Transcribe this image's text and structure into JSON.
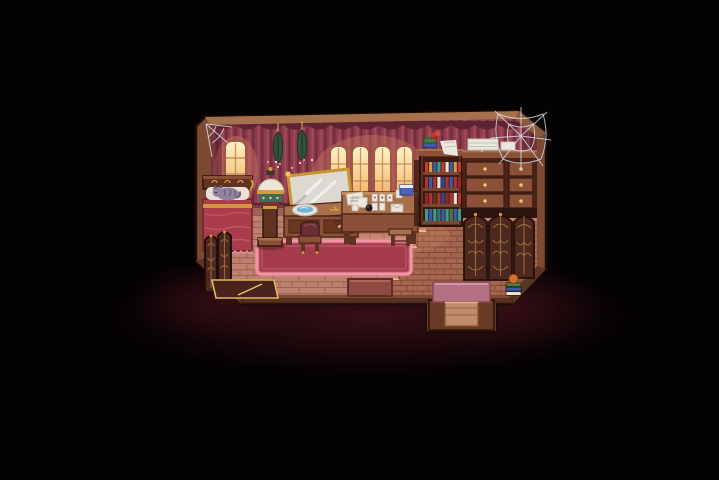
{
  "meta": {
    "scene": "Pixel-art cottage bedroom and study at night, warm candlelit windows, dark vignette surround",
    "view": "top-down RPG room interior",
    "canvas": {
      "width": 719,
      "height": 480
    }
  },
  "palette": {
    "background": "#050203",
    "outerGlow": "#2d0a0e",
    "trim": "#7c4a33",
    "trimLight": "#a5714c",
    "trimDark": "#3a1c11",
    "wall": "#733040",
    "wallBase": "#7e3a44",
    "curtain": "#8e3c4c",
    "curtainDark": "#722e3e",
    "curtainLight": "#a34e5e",
    "valance": "#5d2331",
    "windowFrame": "#9c5844",
    "windowGlowTop": "#fff3c9",
    "windowGlowBottom": "#f3a963",
    "floor": "#bd8170",
    "floorLine": "#9a5c4f",
    "platform": "#a5654f",
    "platformLine": "#7e4736",
    "platformEdge": "#eeb08d",
    "rug": "#a33b4a",
    "rugBorder": "#ea8f9e",
    "bed": "#aa3c4b",
    "bedHighlight": "#c75b66",
    "pillow": "#eae0d6",
    "cat": "#93849e",
    "catDark": "#6d5e7e",
    "wood": "#8a5138",
    "woodLight": "#a86f4b",
    "woodDark": "#5e3322",
    "gold": "#d39c3f",
    "goldBright": "#edc668",
    "mirror": "#ded8d2",
    "water": "#6fb3d6",
    "paper": "#ece7de",
    "herb": "#33523a",
    "cobweb": "#dde2ee",
    "matPink": "#b27082",
    "doorPlank": "#c08a6c",
    "screenWood": "#4c281e",
    "carving": "#9c6a40"
  },
  "windows": {
    "left_count": 1,
    "center_count": 4,
    "state": "glowing warm light"
  },
  "bookshelf": {
    "spine_width": 3.2,
    "spine_gap": 0.9,
    "start_x": 425,
    "rows": [
      {
        "shelfY": 172,
        "h": 10,
        "colors": [
          "#c23a30",
          "#d39c3f",
          "#3c5cab",
          "#3d9a90",
          "#c23a30",
          "#e6e2d6",
          "#3c5cab",
          "#d39c3f",
          "#c23a30"
        ]
      },
      {
        "shelfY": 188,
        "h": 11,
        "colors": [
          "#ab3434",
          "#3c5cab",
          "#ab3434",
          "#e6e2d6",
          "#2e4a8e",
          "#ab3434",
          "#3c5cab",
          "#ab3434",
          "#8e2a2a"
        ]
      },
      {
        "shelfY": 204,
        "h": 11,
        "colors": [
          "#8e2a2a",
          "#ab3434",
          "#5e3322",
          "#ab3434",
          "#2e4a8e",
          "#8e2a2a",
          "#ab3434",
          "#e6e2d6",
          "#ab3434"
        ]
      },
      {
        "shelfY": 221,
        "h": 12,
        "colors": [
          "#3d9a90",
          "#3c5cab",
          "#3d9a90",
          "#2e7a72",
          "#3c5cab",
          "#3d9a90",
          "#45803f",
          "#3c5cab",
          "#3d9a90"
        ]
      }
    ]
  },
  "corner_books": {
    "x": 506,
    "w": 15,
    "spine_h": 4.4,
    "base_y": 296,
    "colors_bottom_to_top": [
      "#e6e2d6",
      "#3c5cab",
      "#45803f"
    ],
    "topper": "pumpkin",
    "topper_color": "#d8702e"
  },
  "objects": [
    {
      "id": "bed",
      "label": "red bed with gold-trimmed headboard and sleeping cat"
    },
    {
      "id": "cat",
      "label": "grey-lavender cat curled on pillow"
    },
    {
      "id": "orb-pedestal",
      "label": "cream orb vessel on wooden pedestal"
    },
    {
      "id": "vanity",
      "label": "gold-framed tilted mirror on dresser with wash basin"
    },
    {
      "id": "stool",
      "label": "small maroon chair-back stool"
    },
    {
      "id": "desk",
      "label": "writing desk with papers, card spread, envelope and blue box"
    },
    {
      "id": "bookshelf",
      "label": "tall bookshelf, four rows of books, flowers and cloth on top"
    },
    {
      "id": "drawers",
      "label": "chest of drawers with linens stacked on counter"
    },
    {
      "id": "carved-screens",
      "label": "three ornately carved dark wood panels"
    },
    {
      "id": "folding-screen",
      "label": "dark carved folding screen, bottom-left"
    },
    {
      "id": "gold-bench",
      "label": "low gold-trimmed bench along bottom wall"
    },
    {
      "id": "rug",
      "label": "large red rug with glowing pink border"
    },
    {
      "id": "door-mat",
      "label": "T-shaped mauve doorway mat leading out at bottom"
    },
    {
      "id": "herbs",
      "label": "two dried herb bundles hanging from curtain rod"
    },
    {
      "id": "cobwebs",
      "label": "cobwebs in top-left and top-right corners"
    }
  ]
}
